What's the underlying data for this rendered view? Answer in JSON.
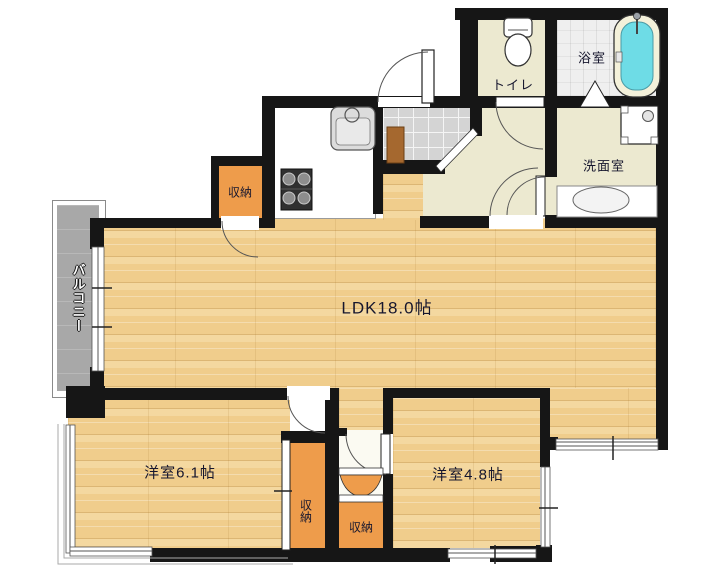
{
  "plan_title": "apartment-floor-plan",
  "labels": {
    "ldk": "LDK18.0帖",
    "bedroom61": "洋室6.1帖",
    "bedroom48": "洋室4.8帖",
    "toilet": "トイレ",
    "bathroom": "浴室",
    "washroom": "洗面室",
    "balcony": "バルコニー",
    "storage_kitchen": "収納",
    "storage_bedroom61": "収納",
    "storage_corridor": "収納"
  },
  "colors": {
    "wall": "#161616",
    "wood_floor": "#f0cd8c",
    "storage_orange": "#ee9c4b",
    "cream_floor": "#ece9d0",
    "bathtub_cyan": "#6edce6",
    "balcony_gray": "#a8a8a8",
    "genkan_tile": "#d4d4d4",
    "step_brown": "#a5682f"
  }
}
